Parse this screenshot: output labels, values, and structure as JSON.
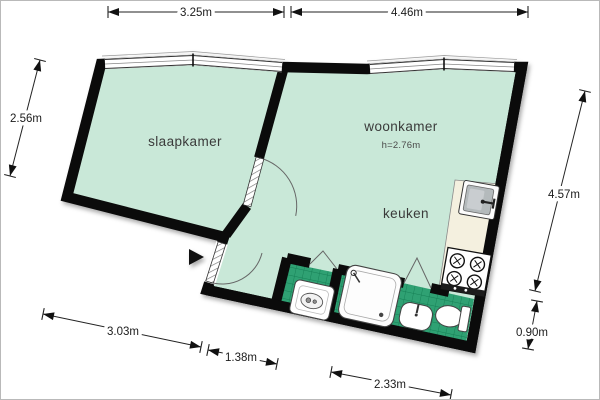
{
  "floor_plan": {
    "rooms": [
      {
        "id": "slaapkamer",
        "label": "slaapkamer"
      },
      {
        "id": "woonkamer",
        "label": "woonkamer",
        "height_note": "h=2.76m"
      },
      {
        "id": "keuken",
        "label": "keuken"
      }
    ],
    "dimensions": {
      "top_left": "3.25m",
      "top_right": "4.46m",
      "left": "2.56m",
      "right": "4.57m",
      "right_lower": "0.90m",
      "bottom_left": "3.03m",
      "bottom_center": "1.38m",
      "bottom_right": "2.33m"
    },
    "colors": {
      "floor": "#c9e8d8",
      "tile": "#2fa173",
      "tile_line": "#157f55",
      "wall": "#0b0b0b",
      "counter": "#f4f0df",
      "label_text": "#3a3a3a",
      "dim_text": "#1b1b1b"
    },
    "fixtures": [
      "kitchen-sink",
      "stove",
      "shower",
      "wc-unit",
      "washbasin",
      "toilet"
    ]
  }
}
